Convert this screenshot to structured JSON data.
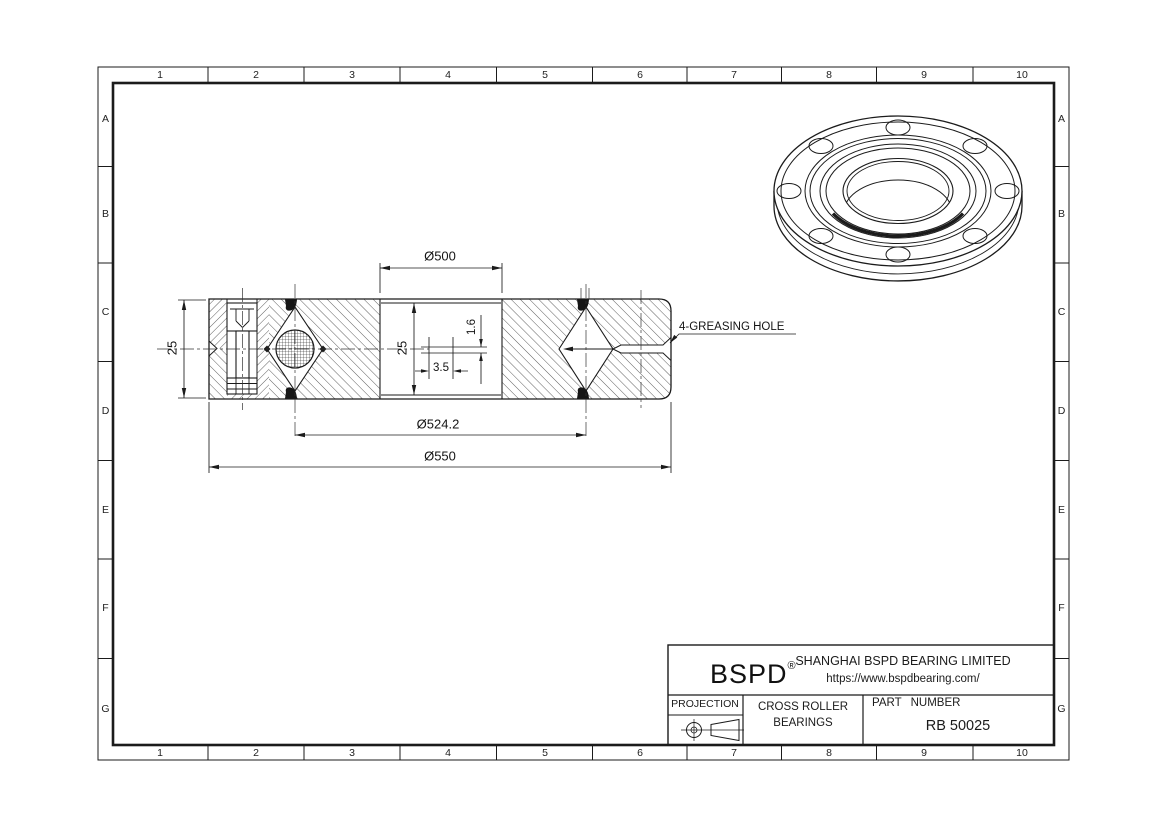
{
  "grid": {
    "columns": [
      "1",
      "2",
      "3",
      "4",
      "5",
      "6",
      "7",
      "8",
      "9",
      "10"
    ],
    "rows": [
      "A",
      "B",
      "C",
      "D",
      "E",
      "F",
      "G"
    ]
  },
  "section": {
    "dim_bore": "Ø500",
    "dim_pitch": "Ø524.2",
    "dim_od": "Ø550",
    "dim_width_left": "25",
    "dim_width_inner": "25",
    "dim_seal_height": "1.6",
    "dim_seal_width": "3.5",
    "greasing_note": "4-GREASING HOLE"
  },
  "title_block": {
    "logo": "BSPD",
    "registered": "®",
    "company": "SHANGHAI BSPD BEARING LIMITED",
    "website": "https://www.bspdbearing.com/",
    "projection_label": "PROJECTION",
    "product_line1": "CROSS ROLLER",
    "product_line2": "BEARINGS",
    "part_number_label": "PART NUMBER",
    "part_number": "RB 50025"
  },
  "colors": {
    "line": "#1b1b1b",
    "background": "#ffffff"
  }
}
